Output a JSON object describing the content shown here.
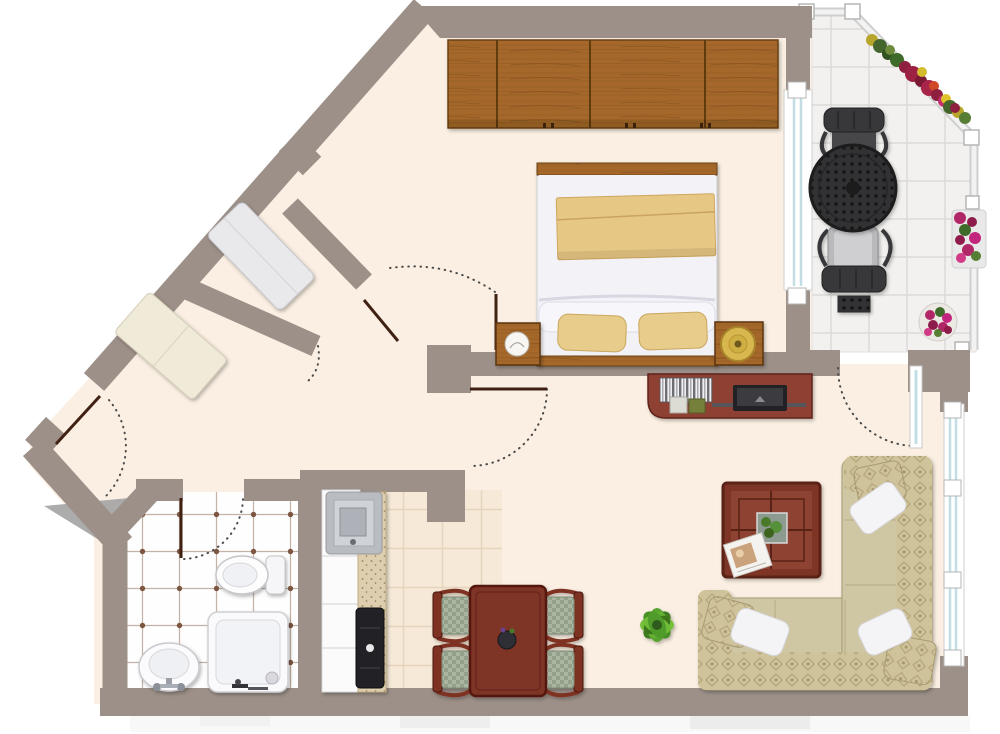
{
  "title": "apartment-floor-plan",
  "palette": {
    "wall": "#9c9088",
    "floor": "#faefe2",
    "bathTile": "#fefefe",
    "bathLine": "#c3b2a5",
    "bathDot": "#7c5640",
    "kitchenTile": "#f6e9d7",
    "kitchenLine": "#e6d4bd",
    "balconyTile": "#f2f1ef",
    "balconyLine": "#dcdad8",
    "wood": "#a5682a",
    "woodDark": "#6b4014",
    "mahogany": "#7f3628",
    "mahoganyDark": "#5a2015",
    "sofaBase": "#cfc6a4",
    "sofaPattern": "#b5a478",
    "upholstery": "#aab6a2",
    "pillowWhite": "#f4f4f6",
    "glass": "#c3dde4",
    "frameWhite": "#ffffff",
    "doorLine": "#3f2013",
    "arcDots": "#4a4a4a",
    "plantGreen": "#57a32e",
    "flowerRed": "#8e1f3e",
    "flowerMagenta": "#b12667",
    "gold": "#d9b74f",
    "charcoal": "#323234",
    "applianceDark": "#222226",
    "stepGray": "#a3a3a3",
    "counterSpeckle": "#dcceae"
  },
  "rooms": [
    {
      "id": "bedroom",
      "furniture": [
        "wardrobe",
        "double-bed",
        "pillows",
        "folded-blanket",
        "nightstand-left",
        "table-lamp",
        "nightstand-right",
        "gold-tray"
      ]
    },
    {
      "id": "living-dining-room",
      "furniture": [
        "media-console",
        "books",
        "tv",
        "coffee-table",
        "potted-plant-box",
        "magazine",
        "corner-sofa",
        "throw-pillows",
        "dining-table",
        "dining-chairs",
        "vase",
        "floor-plant"
      ]
    },
    {
      "id": "kitchen",
      "furniture": [
        "counter",
        "sink-unit",
        "stove"
      ]
    },
    {
      "id": "bathroom",
      "furniture": [
        "washbasin",
        "toilet",
        "shower-tray"
      ]
    },
    {
      "id": "hallway",
      "furniture": [
        "wardrobe-box-gray",
        "sideboard-box-cream",
        "entrance-step"
      ]
    },
    {
      "id": "balcony",
      "furniture": [
        "round-mesh-table",
        "chair-north",
        "chair-south",
        "flower-box-diagonal",
        "flower-box-rail",
        "flower-pot"
      ]
    }
  ],
  "counts": {
    "dining_chairs": 4,
    "balcony_chairs": 2,
    "sofa_white_pillows": 3,
    "wardrobe_sections": 4
  },
  "openings": {
    "doors": [
      "entrance-door",
      "bedroom-door",
      "bathroom-door",
      "living-room-door",
      "balcony-door"
    ],
    "windows": [
      "bedroom-balcony-window",
      "living-room-side-window"
    ],
    "railing": "balcony-railing"
  }
}
